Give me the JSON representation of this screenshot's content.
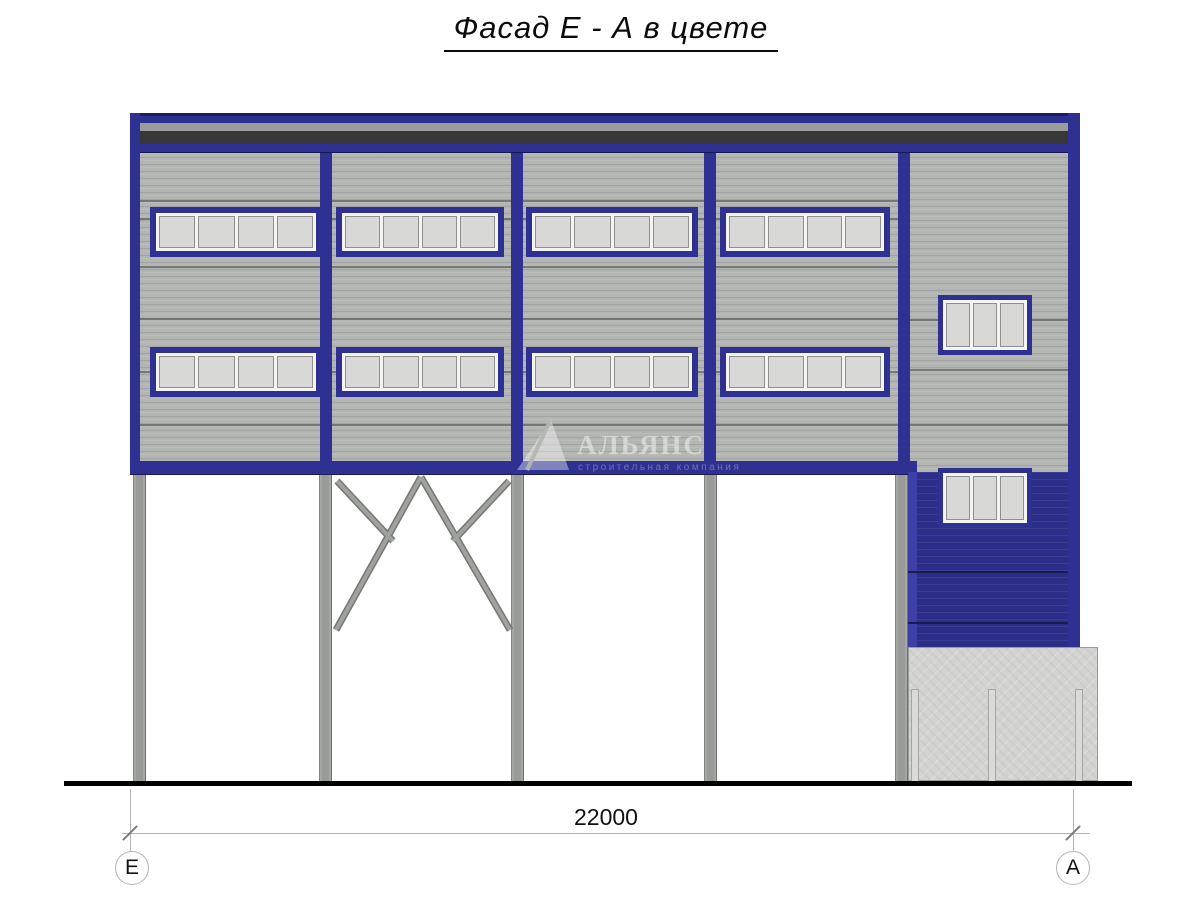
{
  "title": "Фасад Е - А в цвете",
  "watermark": {
    "logo": "sail-triangle",
    "name": "АЛЬЯНС",
    "subtitle": "строительная компания"
  },
  "dimension": {
    "total_length": "22000"
  },
  "axis_markers": {
    "left": "Е",
    "right": "А"
  },
  "colors": {
    "facade_blue": "#2e3192",
    "wall_blue_dark": "#2b2d88",
    "panel_gray": "#b2b5b2",
    "pane_gray": "#d8d9d6",
    "roof_stripe_dark": "#383838",
    "concrete_gray": "#d3d4d1",
    "steel_gray": "#9da09d"
  }
}
